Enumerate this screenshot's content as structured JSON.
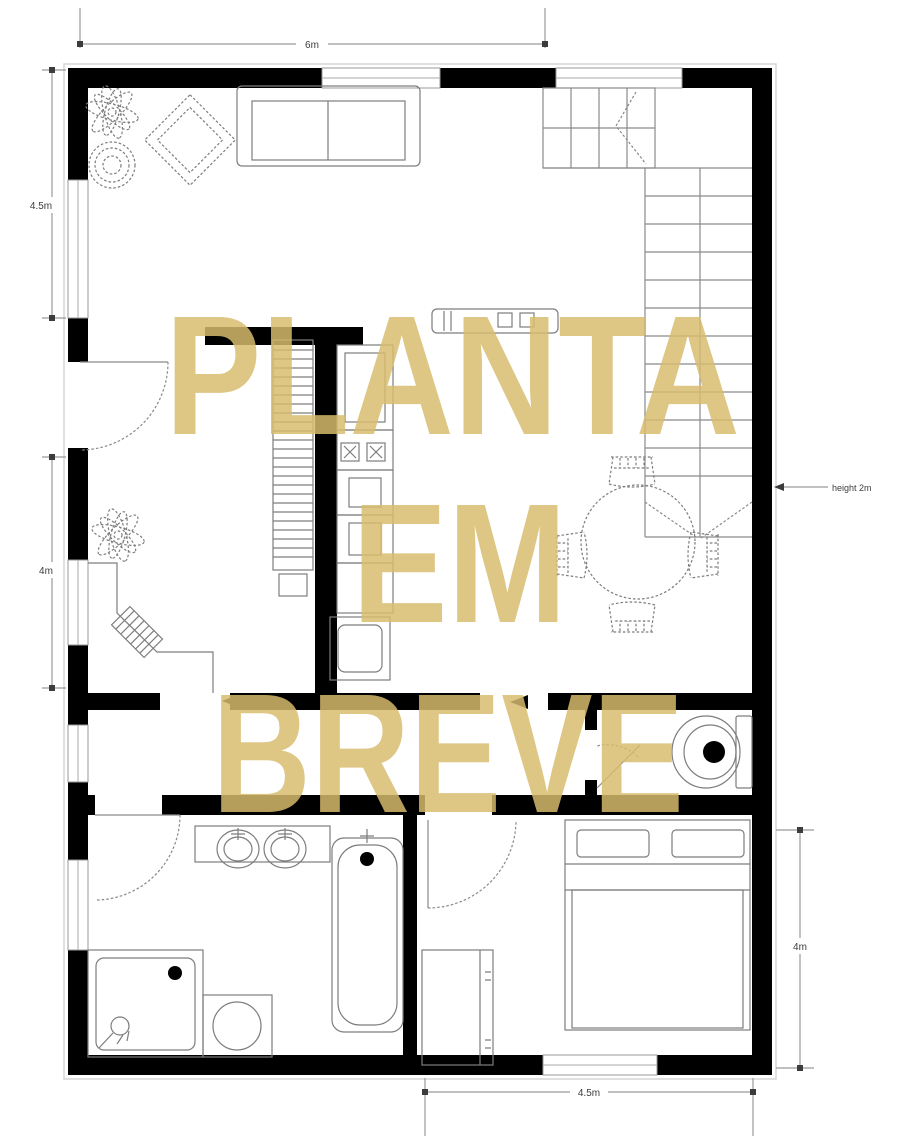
{
  "watermark": {
    "line1": "PLANTA",
    "line2": "EM",
    "line3": "BREVE",
    "color": "#D8BC6E"
  },
  "dimensions": {
    "top": "6m",
    "left_upper": "4.5m",
    "left_lower": "4m",
    "right_lower": "4m",
    "bottom": "4.5m"
  },
  "annotations": {
    "stair_height": "height 2m"
  },
  "colors": {
    "wall": "#000000",
    "thin_line": "#8a8a8a",
    "window": "#ffffff",
    "background": "#ffffff",
    "dimension_text": "#3c3c3c"
  },
  "furniture_icons": [
    "sofa",
    "armchair",
    "plant",
    "planter-pot",
    "corner-desk",
    "desk-chair",
    "shelving-unit",
    "kitchen-counter",
    "cooktop",
    "kitchen-sink",
    "bar-counter",
    "dining-table",
    "dining-chair",
    "staircase",
    "toilet",
    "double-vanity",
    "bathtub",
    "shower",
    "washing-machine",
    "double-bed",
    "wardrobe"
  ]
}
